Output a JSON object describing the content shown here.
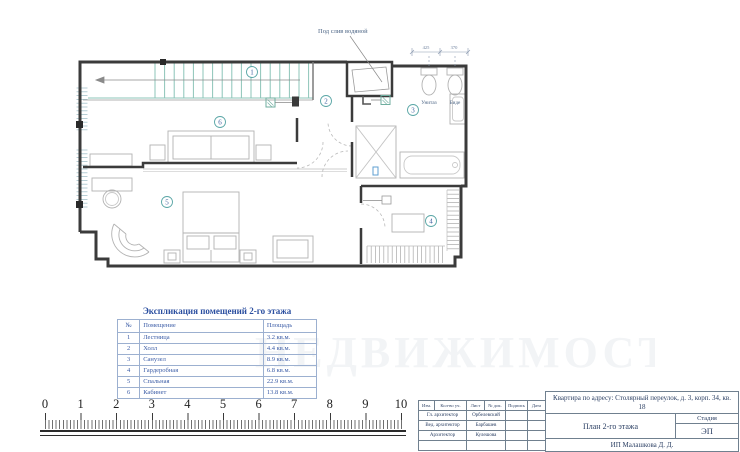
{
  "plan": {
    "note": "Под слив водяной",
    "toilet_label": "Унитаз",
    "bidet_label": "Биде",
    "dim1": "425",
    "dim2": "370",
    "room_numbers": [
      "1",
      "2",
      "3",
      "4",
      "5",
      "6"
    ]
  },
  "legend": {
    "title": "Экспликация помещений 2-го этажа",
    "headers": {
      "num": "№",
      "room": "Помещение",
      "area": "Площадь"
    },
    "rows": [
      {
        "num": "1",
        "room": "Лестница",
        "area": "3.2 кв.м."
      },
      {
        "num": "2",
        "room": "Холл",
        "area": "4.4 кв.м."
      },
      {
        "num": "3",
        "room": "Санузел",
        "area": "8.9 кв.м."
      },
      {
        "num": "4",
        "room": "Гардеробная",
        "area": "6.8 кв.м."
      },
      {
        "num": "5",
        "room": "Спальная",
        "area": "22.9 кв.м."
      },
      {
        "num": "6",
        "room": "Кабинет",
        "area": "13.8 кв.м."
      }
    ]
  },
  "ruler": {
    "marks": [
      "0",
      "1",
      "2",
      "3",
      "4",
      "5",
      "6",
      "7",
      "8",
      "9",
      "10"
    ]
  },
  "watermark": "НЕДВИЖИМОСТЬ",
  "title_block": {
    "address": "Квартира по адресу: Столярный переулок, д. 3, корп. 34, кв. 18",
    "columns": [
      "Изм.",
      "Кол-во уч.",
      "Лист",
      "№ док.",
      "Подпись",
      "Дата"
    ],
    "staff": [
      {
        "role": "Гл. архитектор",
        "name": "Орбелевский"
      },
      {
        "role": "Вед. архитектор",
        "name": "Барбашев"
      },
      {
        "role": "Архитектор",
        "name": "Кулешова"
      }
    ],
    "drawing_title": "План 2-го этажа",
    "stage_label": "Стадия",
    "stage_value": "ЭП",
    "company": "ИП Малашкова Д. Д."
  }
}
